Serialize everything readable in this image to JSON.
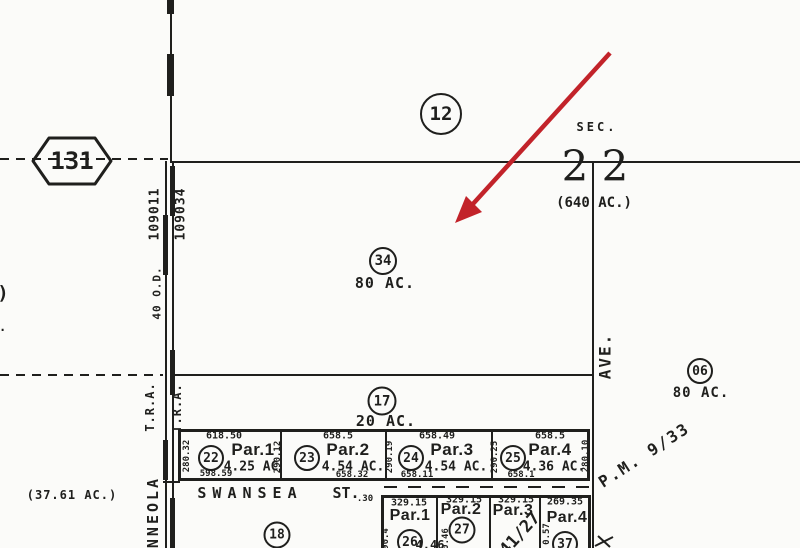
{
  "colors": {
    "ink": "#1f1f1d",
    "paper": "#fbfbf9",
    "arrow_red": "#c2232a"
  },
  "shield": {
    "route": "131"
  },
  "section": {
    "circle_label": "12",
    "sec_label": "SEC.",
    "numbers": "2 2",
    "acreage": "(640 AC.)"
  },
  "roads": {
    "tra_code_left": "109011",
    "tra_code_right": "109034",
    "tra_left": "T.R.A.",
    "tra_right": "T.R.A.",
    "width_label": "40 O.D.",
    "minneola_partial": "NNEOLA",
    "swansea": "SWANSEA",
    "swansea_st": "ST.",
    "swansea_offset": ".30",
    "avenue": "AVE."
  },
  "parcels": {
    "p34": {
      "circle": "34",
      "acres": "80 AC."
    },
    "p17": {
      "circle": "17",
      "acres": "20 AC."
    },
    "p06": {
      "circle": "06",
      "acres": "80 AC."
    },
    "p18": {
      "circle": "18"
    },
    "left_acreage": "(37.61 AC.)",
    "upper": [
      {
        "circle": "22",
        "name": "Par.1",
        "acres": "4.25 AC",
        "top": "618.50",
        "bottom": "598.59",
        "side": "280.32"
      },
      {
        "circle": "23",
        "name": "Par.2",
        "acres": "4.54 AC.",
        "top": "658.5",
        "bottom": "658.32",
        "side": "290.12"
      },
      {
        "circle": "24",
        "name": "Par.3",
        "acres": "4.54 AC.",
        "top": "658.49",
        "bottom": "658.11",
        "side": "290.19"
      },
      {
        "circle": "25",
        "name": "Par.4",
        "acres": "4.36 AC.",
        "top": "658.5",
        "bottom": "658.1",
        "side": "290.25",
        "side_right": "280.10"
      }
    ],
    "lower": [
      {
        "circle": "26",
        "name": "Par.1",
        "top": "329.15",
        "side": "90.4"
      },
      {
        "circle": "27",
        "name": "Par.2",
        "top": "329.15",
        "side": "0.46",
        "fragment": "4.46"
      },
      {
        "name": "Par.3",
        "top": "329.15",
        "diagonal": "41/27"
      },
      {
        "circle": "37",
        "name": "Par.4",
        "top": "269.35",
        "side": "0.57"
      }
    ]
  },
  "references": {
    "pm933": "P.M. 9/33"
  },
  "fragments": {
    "paren": ")",
    "c": "C."
  }
}
